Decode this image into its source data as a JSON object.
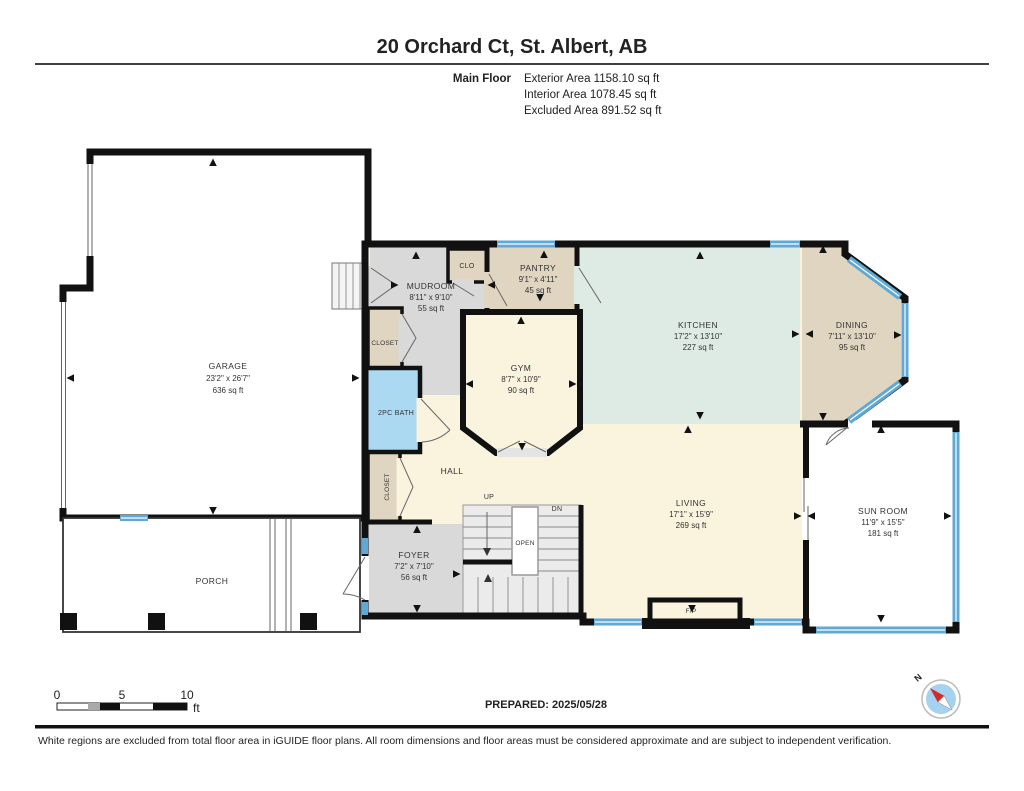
{
  "header": {
    "title": "20 Orchard Ct, St. Albert, AB",
    "floor_label": "Main Floor",
    "areas": [
      "Exterior Area 1158.10 sq ft",
      "Interior Area 1078.45 sq ft",
      "Excluded Area 891.52 sq ft"
    ]
  },
  "rooms": {
    "garage": {
      "name": "GARAGE",
      "dims": "23'2\" x 26'7\"",
      "area": "636 sq ft"
    },
    "mudroom": {
      "name": "MUDROOM",
      "dims": "8'11\" x 9'10\"",
      "area": "55 sq ft"
    },
    "pantry": {
      "name": "PANTRY",
      "dims": "9'1\" x 4'11\"",
      "area": "45 sq ft"
    },
    "kitchen": {
      "name": "KITCHEN",
      "dims": "17'2\" x 13'10\"",
      "area": "227 sq ft"
    },
    "dining": {
      "name": "DINING",
      "dims": "7'11\" x 13'10\"",
      "area": "95 sq ft"
    },
    "gym": {
      "name": "GYM",
      "dims": "8'7\" x 10'9\"",
      "area": "90 sq ft"
    },
    "living": {
      "name": "LIVING",
      "dims": "17'1\" x 15'9\"",
      "area": "269 sq ft"
    },
    "sunroom": {
      "name": "SUN ROOM",
      "dims": "11'9\" x 15'5\"",
      "area": "181 sq ft"
    },
    "foyer": {
      "name": "FOYER",
      "dims": "7'2\" x 7'10\"",
      "area": "56 sq ft"
    }
  },
  "labels": {
    "bath": "2PC BATH",
    "clo": "CLO",
    "closet": "CLOSET",
    "hall": "HALL",
    "porch": "PORCH",
    "fireplace": "F/P",
    "up": "UP",
    "dn": "DN",
    "open": "OPEN"
  },
  "scale_bar": {
    "tick0": "0",
    "tick1": "5",
    "tick2": "10",
    "unit": "ft"
  },
  "footer": {
    "prepared": "PREPARED: 2025/05/28",
    "compass_label": "N",
    "disclaimer": "White regions are excluded from total floor area in iGUIDE floor plans. All room dimensions and floor areas must be considered approximate and are subject to independent verification."
  },
  "colors": {
    "wall": "#111111",
    "window_blue": "#5FA9D6",
    "bath_blue": "#ABD9F1",
    "cream": "#FAF3DE",
    "mint": "#DEEBE4",
    "tan": "#E0D5C1",
    "gray": "#D9D9D9",
    "compass_fill": "#A5D2EE",
    "compass_needle": "#D42A2A"
  }
}
